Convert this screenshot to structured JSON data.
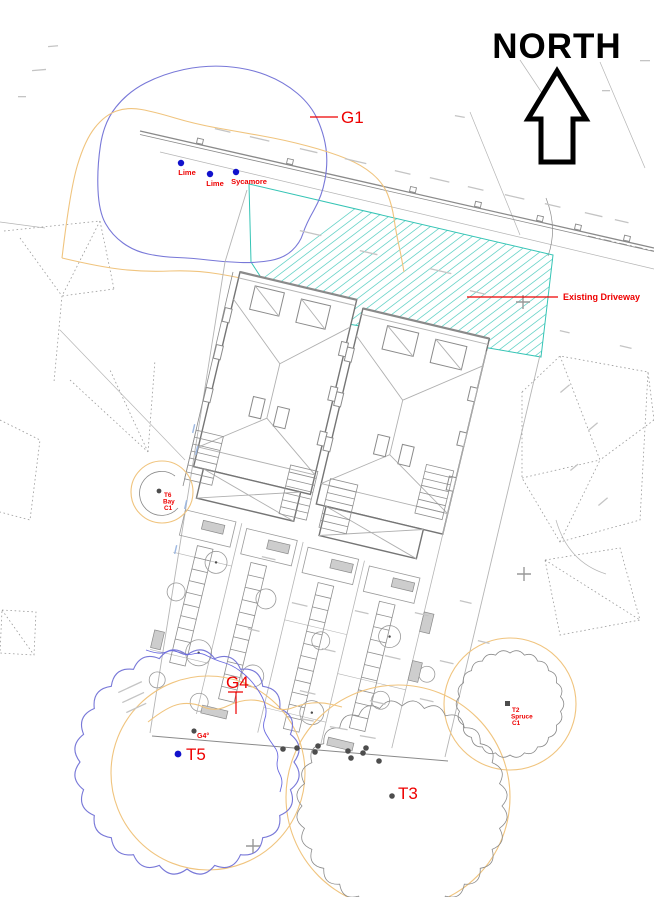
{
  "north": {
    "label": "NORTH"
  },
  "labels": {
    "g1": "G1",
    "existing_driveway": "Existing Driveway",
    "g4": "G4",
    "g4_stem": "G4°",
    "t5": "T5",
    "t3": "T3",
    "lime_a": "Lime",
    "lime_b": "Lime",
    "sycamore": "Sycamore",
    "t2_id": "T2",
    "t2_species": "Spruce",
    "t2_category": "C1",
    "t6_id": "T6",
    "t6_species": "Bay",
    "t6_category": "C1"
  },
  "colors": {
    "annotation_red": "#ee0000",
    "tree_point_blue": "#1212cc",
    "canopy_blue": "#7878d8",
    "rpa_orange": "#f0c47e",
    "driveway_teal": "#35c4b5",
    "cad_gray": "#8a8a8a"
  }
}
